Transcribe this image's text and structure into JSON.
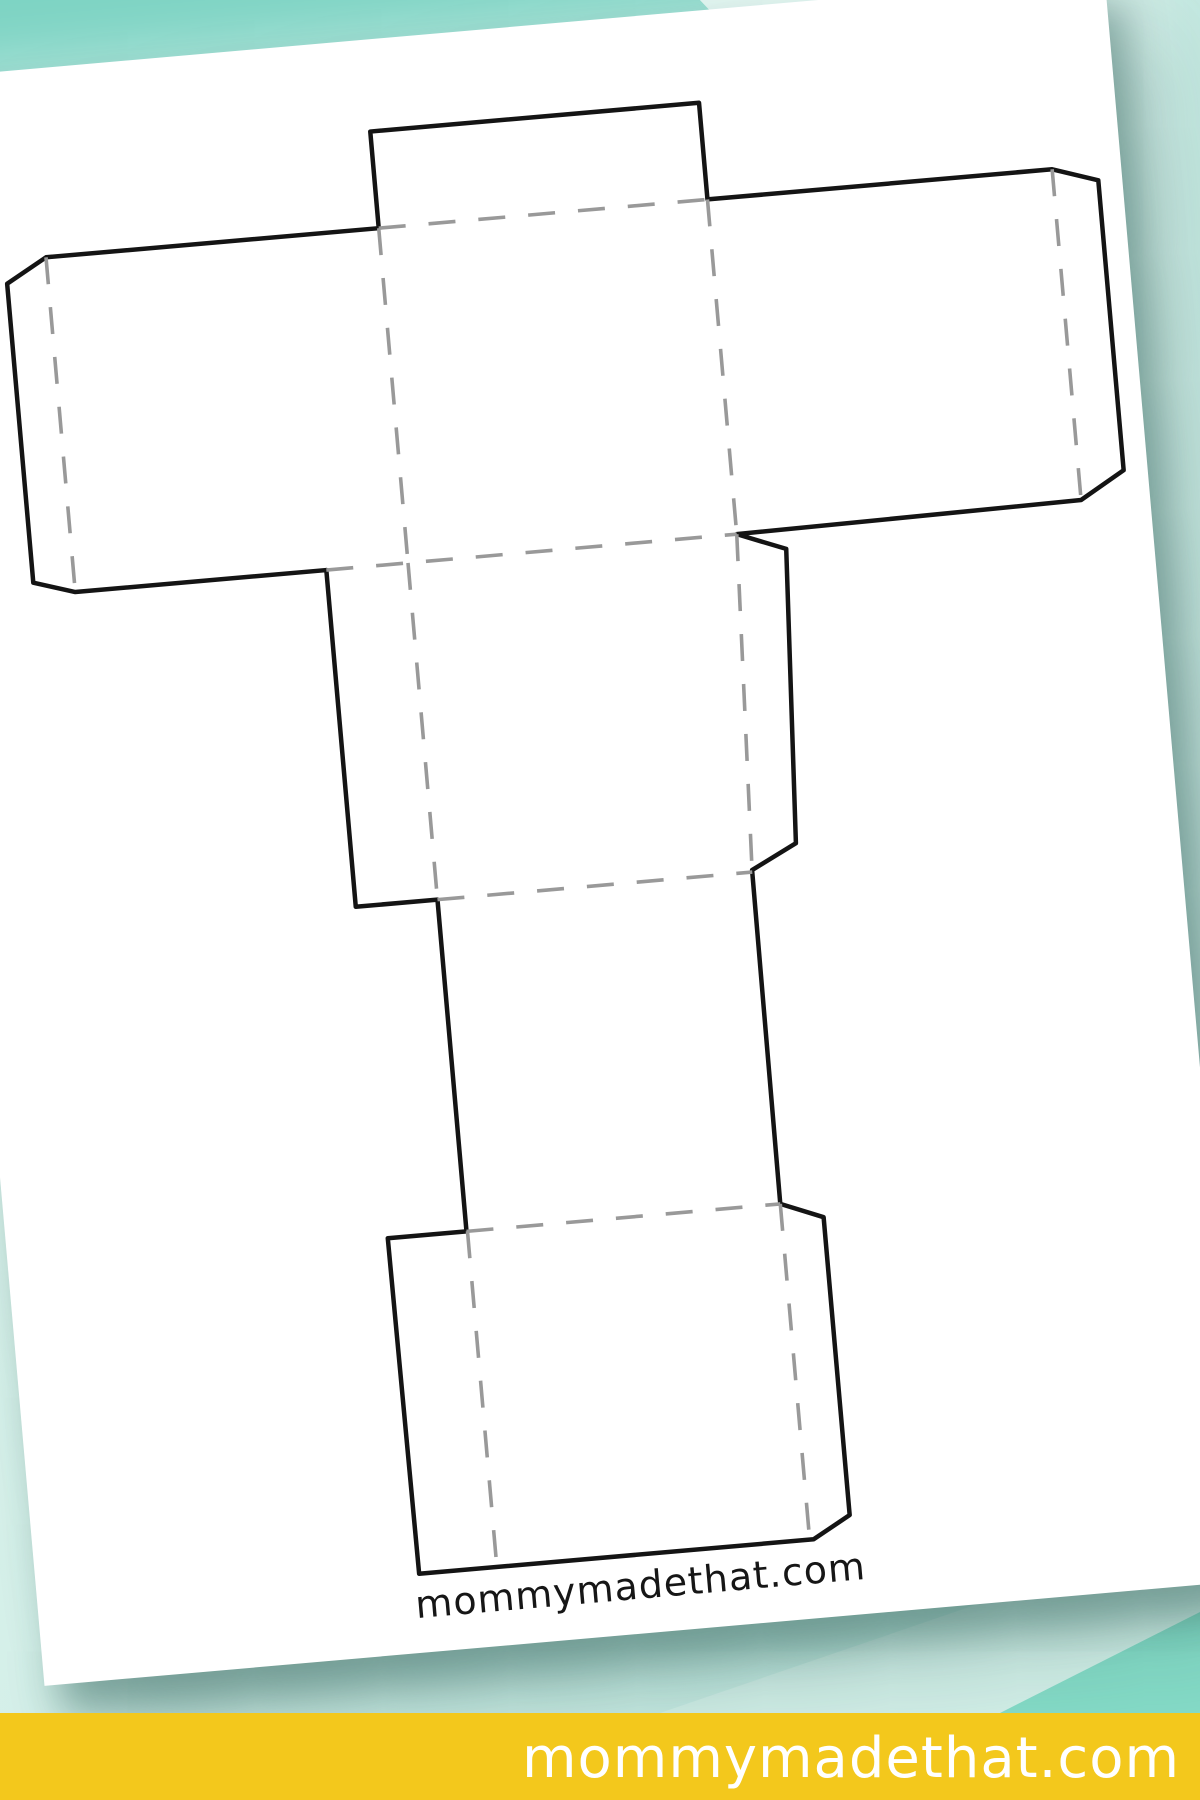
{
  "page": {
    "background": {
      "base_gradient": [
        "#def4ee",
        "#c2e8e0"
      ],
      "top_band_color": "#7ed4c4",
      "top_band_light_color": "#d9f2ec",
      "bottom_wedge_light_color": "#d4f0e9",
      "bottom_wedge_bright_color": "#86dcc8"
    },
    "paper": {
      "color": "#ffffff",
      "rotation_deg": -5,
      "credit_text": "mommymadethat.com"
    },
    "template": {
      "name": "letter-t-box-template",
      "outline_color": "#141414",
      "fold_color": "#999999",
      "outline_width": 4.5,
      "fold_width": 3.6,
      "dash_pattern": "27 23",
      "viewbox": [
        0,
        0,
        1205,
        1612
      ],
      "outline_points": [
        [
          460,
          92
        ],
        [
          790,
          92
        ],
        [
          790,
          189
        ],
        [
          1136,
          189
        ],
        [
          1181,
          204
        ],
        [
          1181,
          495
        ],
        [
          1136,
          521
        ],
        [
          790,
          525
        ],
        [
          838,
          544
        ],
        [
          822,
          838
        ],
        [
          776,
          861
        ],
        [
          775,
          1196
        ],
        [
          817,
          1213
        ],
        [
          817,
          1512
        ],
        [
          779,
          1533
        ],
        [
          383,
          1533
        ],
        [
          381,
          1196
        ],
        [
          460,
          1196
        ],
        [
          460,
          863
        ],
        [
          378,
          863
        ],
        [
          378,
          525
        ],
        [
          126,
          525
        ],
        [
          85,
          512
        ],
        [
          85,
          212
        ],
        [
          126,
          189
        ],
        [
          460,
          189
        ]
      ],
      "fold_lines": [
        [
          [
            460,
            189
          ],
          [
            790,
            189
          ]
        ],
        [
          [
            126,
            189
          ],
          [
            126,
            525
          ]
        ],
        [
          [
            1136,
            189
          ],
          [
            1136,
            521
          ]
        ],
        [
          [
            460,
            189
          ],
          [
            460,
            525
          ]
        ],
        [
          [
            790,
            189
          ],
          [
            790,
            525
          ]
        ],
        [
          [
            378,
            525
          ],
          [
            790,
            525
          ]
        ],
        [
          [
            460,
            525
          ],
          [
            460,
            863
          ]
        ],
        [
          [
            790,
            525
          ],
          [
            776,
            861
          ]
        ],
        [
          [
            460,
            863
          ],
          [
            776,
            863
          ]
        ],
        [
          [
            460,
            1196
          ],
          [
            775,
            1196
          ]
        ],
        [
          [
            461,
            1196
          ],
          [
            461,
            1533
          ]
        ],
        [
          [
            775,
            1196
          ],
          [
            775,
            1530
          ]
        ]
      ]
    },
    "footer": {
      "text": "mommymadethat.com",
      "background": "#f3c81c",
      "text_color": "#ffffff"
    }
  }
}
